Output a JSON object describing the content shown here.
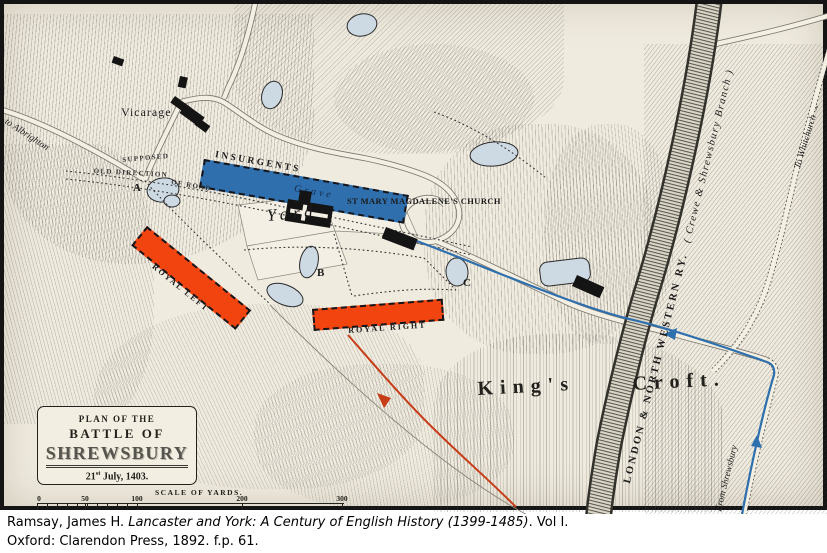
{
  "page": {
    "caption_line1_roman": "Ramsay, James H. ",
    "caption_line1_italic": "Lancaster and York: A Century of English History (1399-1485)",
    "caption_line1_tail": ". Vol I.",
    "caption_line2": "Oxford: Clarendon Press, 1892. f.p. 61."
  },
  "title_box": {
    "line1": "PLAN OF THE",
    "line2": "BATTLE OF",
    "line3": "SHREWSBURY",
    "date_num": "21",
    "date_sup": "st",
    "date_rest": " July, 1403."
  },
  "scale_bar": {
    "label": "SCALE OF YARDS.",
    "t0": "0",
    "t50": "50",
    "t100": "100",
    "t200": "200",
    "t300": "300"
  },
  "forces": {
    "insurgents": {
      "label": "INSURGENTS",
      "color": "#2f6fad"
    },
    "royal_left": {
      "label": "ROYAL LEFT",
      "color": "#f1440e"
    },
    "royal_right": {
      "label": "ROYAL RIGHT",
      "color": "#f1440e"
    }
  },
  "labels": {
    "vicarage": "Vicarage",
    "church": "ST MARY MAGDALENE'S CHURCH",
    "yard": "Yard",
    "grave": "Grave",
    "supposed": "SUPPOSED",
    "old_direction": "OLD DIRECTION",
    "of_road": "OF ROAD",
    "kings": "King's",
    "croft": "Croft.",
    "railway_main": "LONDON & NORTH WESTERN RY.",
    "railway_branch": "( Crewe & Shrewsbury Branch )",
    "to_whitchurch": "To Whitchurch →",
    "from_shrewsbury": "From Shrewsbury",
    "to_albrighton": "to Albrighton",
    "marker_a": "A",
    "marker_b": "B",
    "marker_c": "C"
  },
  "colors": {
    "insurgent_blue": "#2f6fad",
    "royal_orange": "#f1440e",
    "route_blue": "#2e6fad",
    "route_red": "#c63d18",
    "pond": "#cdd9e3",
    "paper": "#f0ebdf"
  }
}
